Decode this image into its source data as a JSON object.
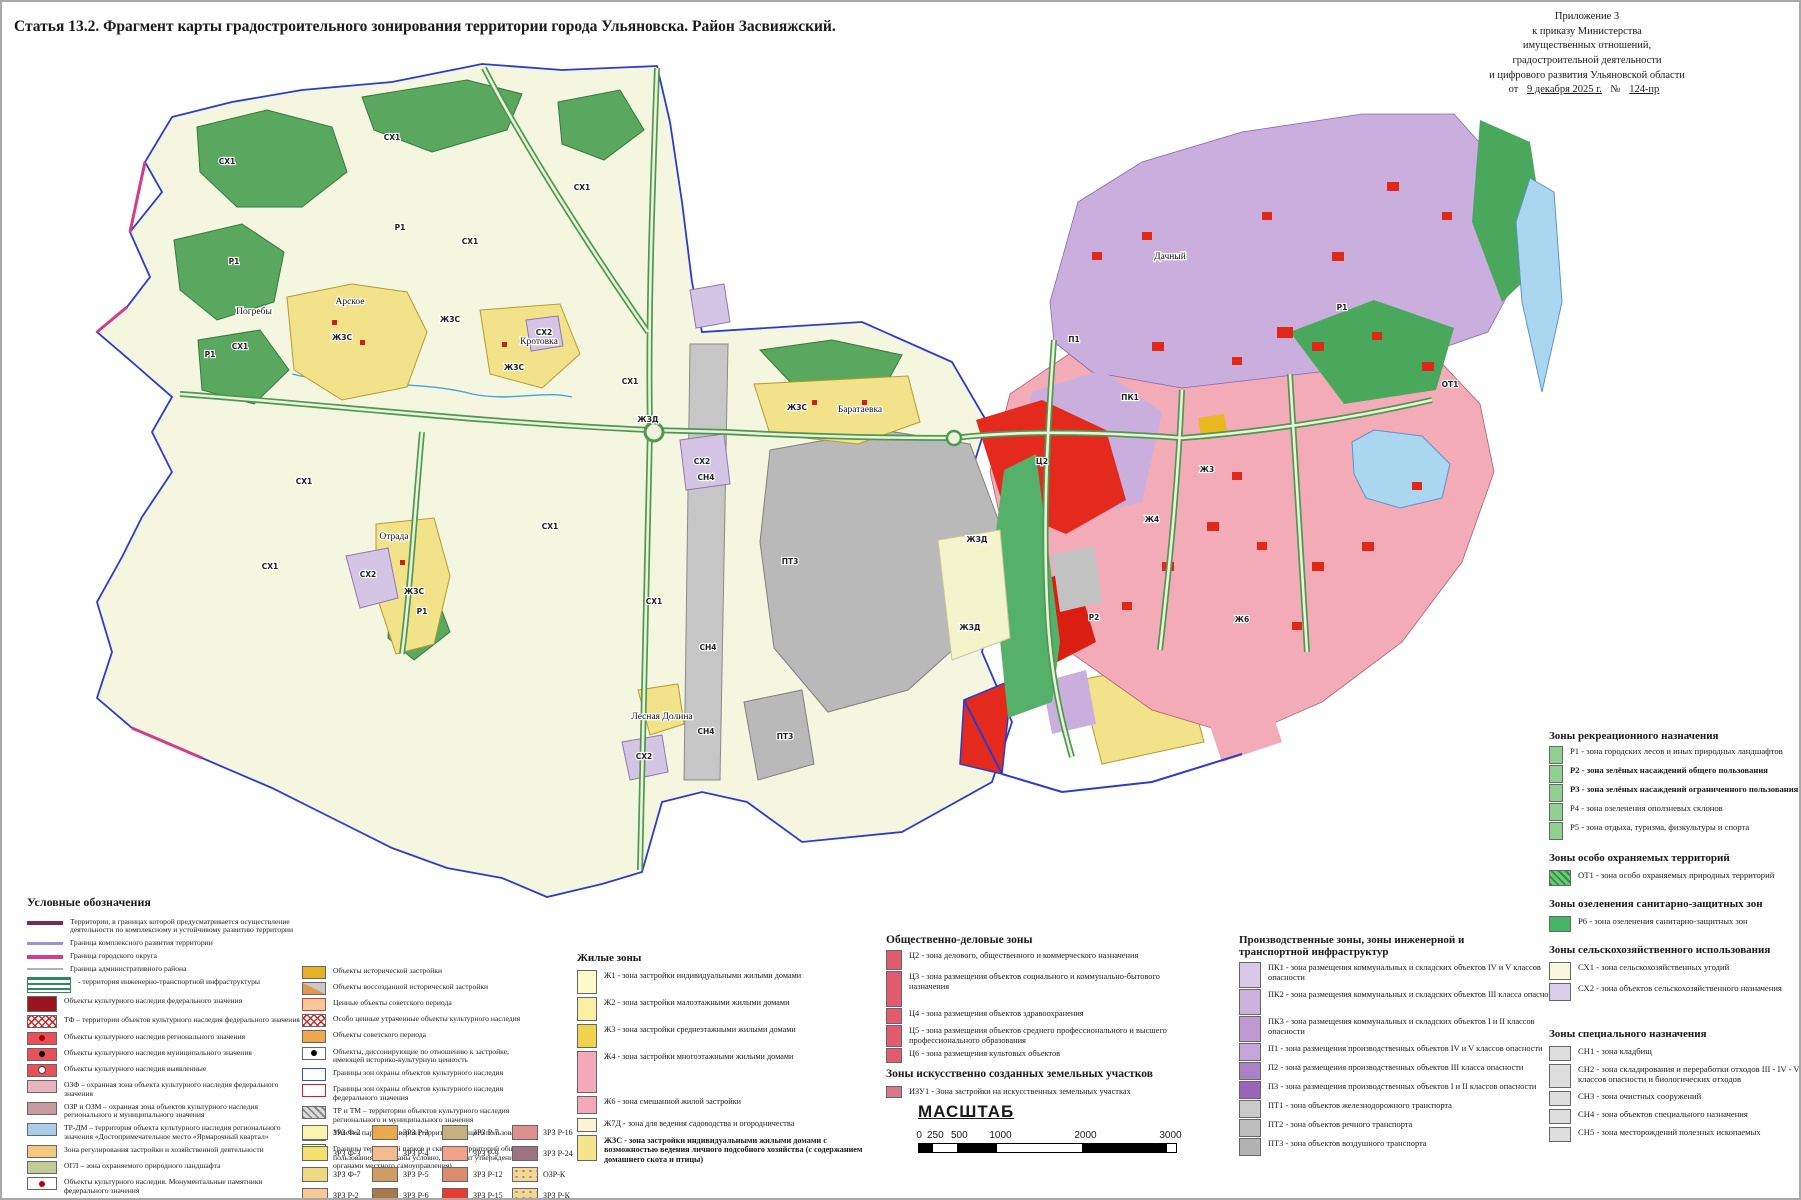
{
  "title": "Статья 13.2. Фрагмент карты градостроительного зонирования территории города Ульяновска. Район Засвияжский.",
  "annex": {
    "lines": [
      "Приложение 3",
      "к приказу Министерства",
      "имущественных отношений,",
      "градостроительной деятельности",
      "и цифрового развития Ульяновской области"
    ],
    "from": "от",
    "date": "9 декабря 2025 г.",
    "no": "№",
    "num": "124-пр"
  },
  "map": {
    "labels": [
      {
        "t": "СХ1",
        "x": 225,
        "y": 162
      },
      {
        "t": "СХ1",
        "x": 390,
        "y": 138
      },
      {
        "t": "СХ1",
        "x": 580,
        "y": 188
      },
      {
        "t": "СХ1",
        "x": 238,
        "y": 347
      },
      {
        "t": "СХ1",
        "x": 468,
        "y": 242
      },
      {
        "t": "СХ1",
        "x": 628,
        "y": 382
      },
      {
        "t": "СХ1",
        "x": 302,
        "y": 482
      },
      {
        "t": "СХ1",
        "x": 268,
        "y": 567
      },
      {
        "t": "СХ1",
        "x": 548,
        "y": 527
      },
      {
        "t": "СХ1",
        "x": 652,
        "y": 602
      },
      {
        "t": "Р1",
        "x": 398,
        "y": 228
      },
      {
        "t": "Р1",
        "x": 232,
        "y": 262
      },
      {
        "t": "Р1",
        "x": 208,
        "y": 355
      },
      {
        "t": "Р1",
        "x": 420,
        "y": 612
      },
      {
        "t": "ЖЗС",
        "x": 340,
        "y": 338
      },
      {
        "t": "ЖЗС",
        "x": 448,
        "y": 320
      },
      {
        "t": "ЖЗС",
        "x": 512,
        "y": 368
      },
      {
        "t": "ЖЗС",
        "x": 412,
        "y": 592
      },
      {
        "t": "ЖЗС",
        "x": 795,
        "y": 408
      },
      {
        "t": "СН4",
        "x": 704,
        "y": 478
      },
      {
        "t": "СН4",
        "x": 706,
        "y": 648
      },
      {
        "t": "СН4",
        "x": 704,
        "y": 732
      },
      {
        "t": "СХ2",
        "x": 366,
        "y": 575
      },
      {
        "t": "СХ2",
        "x": 700,
        "y": 462
      },
      {
        "t": "СХ2",
        "x": 542,
        "y": 333
      },
      {
        "t": "СХ2",
        "x": 642,
        "y": 757
      },
      {
        "t": "ПТ3",
        "x": 788,
        "y": 562
      },
      {
        "t": "ПТ3",
        "x": 783,
        "y": 737
      },
      {
        "t": "ЖЗД",
        "x": 646,
        "y": 420
      },
      {
        "t": "ЖЗД",
        "x": 975,
        "y": 540
      },
      {
        "t": "ЖЗД",
        "x": 968,
        "y": 628
      },
      {
        "t": "ПК1",
        "x": 1128,
        "y": 398
      },
      {
        "t": "П1",
        "x": 1072,
        "y": 340
      },
      {
        "t": "Ж4",
        "x": 1150,
        "y": 520
      },
      {
        "t": "Ж6",
        "x": 1240,
        "y": 620
      },
      {
        "t": "Ц2",
        "x": 1040,
        "y": 462
      },
      {
        "t": "Р1",
        "x": 1340,
        "y": 308
      },
      {
        "t": "ОТ1",
        "x": 1448,
        "y": 385
      },
      {
        "t": "Р2",
        "x": 1092,
        "y": 618
      },
      {
        "t": "Ж3",
        "x": 1205,
        "y": 470
      },
      {
        "t": "Погребы",
        "x": 252,
        "y": 312,
        "k": "place"
      },
      {
        "t": "Арское",
        "x": 348,
        "y": 302,
        "k": "place"
      },
      {
        "t": "Кротовка",
        "x": 537,
        "y": 342,
        "k": "place"
      },
      {
        "t": "Отрада",
        "x": 392,
        "y": 537,
        "k": "place"
      },
      {
        "t": "Баратаевка",
        "x": 858,
        "y": 410,
        "k": "place"
      },
      {
        "t": "Лесная Долина",
        "x": 660,
        "y": 717,
        "k": "place"
      },
      {
        "t": "Дачный",
        "x": 1168,
        "y": 257,
        "k": "place"
      }
    ]
  },
  "legend": {
    "conventions": {
      "heading": "Условные обозначения",
      "col1": [
        {
          "sw": {
            "line": 1,
            "bg": "#7b2a50",
            "h": 4
          },
          "label": "Территории, в границах которой предусматривается осуществление деятельности по комплексному и устойчивому развитию территории"
        },
        {
          "sw": {
            "line": 1,
            "bg": "#9d8fd6",
            "h": 3
          },
          "label": "Граница комплексного развития территории"
        },
        {
          "sw": {
            "line": 1,
            "bg": "#d23c8c",
            "h": 4
          },
          "label": "Граница городского округа"
        },
        {
          "sw": {
            "line": 1,
            "bg": "#b0b0b8",
            "h": 2
          },
          "label": "Граница административного района"
        },
        {
          "sw": {
            "cls": "hatchG",
            "w": 44,
            "h": 16
          },
          "label": "- территория инженерно-транспортной инфраструктуры"
        },
        {
          "sw": {
            "bg": "#9b1420",
            "h": 16
          },
          "label": "Объекты культурного наследия федерального значения"
        },
        {
          "sw": {
            "cls": "hatchRX"
          },
          "label": "ТФ – территории объектов культурного наследия федерального значения"
        },
        {
          "sw": {
            "bg": "#e8505a",
            "dot": "#b00000"
          },
          "label": "Объекты культурного наследия регионального значения"
        },
        {
          "sw": {
            "bg": "#e8505a",
            "dot": "#000000"
          },
          "label": "Объекты культурного наследия муниципального значения"
        },
        {
          "sw": {
            "bg": "#e8505a",
            "dot": "#fff"
          },
          "label": "Объекты культурного наследия  выявленные"
        },
        {
          "sw": {
            "bg": "#e8b4c0"
          },
          "label": "ОЗФ – охранная зона объекта культурного наследия федерального значения"
        },
        {
          "sw": {
            "bg": "#c79aa0"
          },
          "label": "ОЗР и ОЗМ – охранная зона объектов культурного наследия регионального и муниципального значения"
        },
        {
          "sw": {
            "bg": "#aacdec"
          },
          "label": "ТР-ДМ – территория объекта культурного наследия регионального значения «Достопримечательное место «Ярмарочный квартал»"
        },
        {
          "sw": {
            "bg": "#f5c980"
          },
          "label": "Зона регулирования застройки и хозяйственной деятельности"
        },
        {
          "sw": {
            "bg": "#c3cc96"
          },
          "label": "ОГЛ – зона охраняемого природного ландшафта"
        },
        {
          "sw": {
            "bg": "#ffffff",
            "dot": "#c00000"
          },
          "label": "Объекты культурного наследия. Монументальные памятники федерального значения"
        },
        {
          "sw": {
            "bg": "#ffffff",
            "spike": 1
          },
          "label": "Объекты культурного наследия. Мемориальные памятники регионального значения"
        },
        {
          "sw": {
            "bg": "#f5a623",
            "border": "#c87800"
          },
          "label": "Объекты, обладающие признаками объектов культурного наследия"
        },
        {
          "sw": {
            "bg": "#f0a830",
            "dot": "#c00000"
          },
          "label": "Объекты ценной исторической застройки"
        }
      ],
      "col2": [
        {
          "sw": {
            "bg": "#e8b028"
          },
          "label": "Объекты исторической застройки"
        },
        {
          "sw": {
            "cls": "split"
          },
          "label": "Объекты воссозданной исторической застройки"
        },
        {
          "sw": {
            "bg": "#f8c898",
            "border": "#d04040"
          },
          "label": "Ценные объекты советского периода"
        },
        {
          "sw": {
            "cls": "hatchRX"
          },
          "label": "Особо ценные утраченные объекты культурного наследия"
        },
        {
          "sw": {
            "bg": "#f0a850"
          },
          "label": "Объекты советского периода"
        },
        {
          "sw": {
            "bg": "#ffffff",
            "dot": "#000000"
          },
          "label": "Объекты, диссонирующие по отношению к застройке, имеющей историко-культурную ценность"
        },
        {
          "sw": {
            "bg": "#ffffff",
            "border": "#2255cc"
          },
          "label": "Границы зон охраны объектов культурного наследия"
        },
        {
          "sw": {
            "bg": "#ffffff",
            "border": "#cc2222"
          },
          "label": "Границы зон охраны объектов культурного наследия федерального значения"
        },
        {
          "sw": {
            "cls": "hatchGy"
          },
          "label": "ТР и ТМ – территории объектов культурного наследия регионального и муниципального значения"
        },
        {
          "sw": {
            "bg": "#d6e8a0"
          },
          "label": "Участки парков и скверов (территории общего пользования)"
        },
        {
          "sw": {
            "bg": "#ffffff",
            "border": "#3a7a1a"
          },
          "label": "Границы территорий парков и скверов (территорий общего пользования) (показаны условно, подлежат утверждению органами местного самоуправления)"
        }
      ],
      "zrz": [
        {
          "code": "ЗРЗ Ф-2",
          "sw": {
            "bg": "#faf3ae"
          }
        },
        {
          "code": "ЗРЗ Ф-3",
          "sw": {
            "bg": "#f4e070"
          }
        },
        {
          "code": "ЗРЗ Ф-7",
          "sw": {
            "bg": "#ecd982"
          }
        },
        {
          "code": "ЗРЗ Р-2",
          "sw": {
            "bg": "#f8c89a"
          }
        },
        {
          "code": "ЗРЗ Р-3",
          "sw": {
            "bg": "#eaa94e"
          }
        },
        {
          "code": "ЗРЗ Р-4",
          "sw": {
            "bg": "#f4ba8e"
          }
        },
        {
          "code": "ЗРЗ Р-5",
          "sw": {
            "bg": "#cf9d64"
          }
        },
        {
          "code": "ЗРЗ Р-6",
          "sw": {
            "bg": "#a9794b"
          }
        },
        {
          "code": "ЗРЗ Р-7",
          "sw": {
            "bg": "#c6b080"
          }
        },
        {
          "code": "ЗРЗ Р-9",
          "sw": {
            "bg": "#f2a288"
          }
        },
        {
          "code": "ЗРЗ Р-12",
          "sw": {
            "bg": "#db8e6e"
          }
        },
        {
          "code": "ЗРЗ Р-15",
          "sw": {
            "bg": "#e73c30"
          }
        },
        {
          "code": "ЗРЗ Р-16",
          "sw": {
            "bg": "#de9090"
          }
        },
        {
          "code": "ЗРЗ Р-24",
          "sw": {
            "bg": "#9e7280"
          }
        },
        {
          "code": "ОЗР-К",
          "sw": {
            "cls": "dots"
          }
        },
        {
          "code": "ЗРЗ Р-К",
          "sw": {
            "cls": "dots"
          }
        }
      ]
    },
    "residential": {
      "heading": "Жилые зоны",
      "items": [
        {
          "sw": {
            "bg": "#fdf9c8",
            "h": 24
          },
          "label": "Ж1  - зона застройки индивидуальными жилыми домами"
        },
        {
          "sw": {
            "bg": "#f8f0a2",
            "h": 24
          },
          "label": "Ж2  - зона застройки малоэтажными жилыми домами"
        },
        {
          "sw": {
            "bg": "#f1d44e",
            "h": 24
          },
          "label": "Ж3  - зона застройки среднеэтажными жилыми домами"
        },
        {
          "sw": {
            "bg": "#f3a9ba",
            "h": 42
          },
          "label": "Ж4  - зона застройки многоэтажными жилыми домами"
        },
        {
          "sw": {
            "bg": "#f3a9ba",
            "h": 18
          },
          "label": "Ж6 - зона смешанной жилой застройки"
        },
        {
          "sw": {
            "bg": "#fbf4d4",
            "h": 14
          },
          "label": "Ж7Д - зона для ведения садоводства и огородничества"
        },
        {
          "sw": {
            "bg": "#f3e48d",
            "h": 26
          },
          "bold": true,
          "label": "ЖЗС - зона застройки индивидуальными жилыми домами с возможностью ведения личного подсобного хозяйства (с содержанием домашнего скота и птицы)"
        }
      ]
    },
    "business": {
      "heading": "Общественно-деловые зоны",
      "items": [
        {
          "sw": {
            "bg": "#e25a6e",
            "h": 20
          },
          "label": "Ц2   - зона делового, общественного и коммерческого назначения"
        },
        {
          "sw": {
            "bg": "#e25a6e",
            "h": 36
          },
          "label": "Ц3   - зона размещения объектов социального и коммунально-бытового назначения"
        },
        {
          "sw": {
            "bg": "#e25a6e",
            "h": 16
          },
          "label": "Ц4 - зона размещения объектов здравоохранения"
        },
        {
          "sw": {
            "bg": "#e25a6e",
            "h": 22
          },
          "label": "Ц5 - зона размещения объектов среднего профессионального и высшего профессионального образования"
        },
        {
          "sw": {
            "bg": "#e25a6e",
            "h": 15
          },
          "label": "Ц6 - зона размещения культовых объектов"
        }
      ]
    },
    "izu": {
      "heading": "Зоны искусственно созданных земельных участков",
      "items": [
        {
          "sw": {
            "bg": "#d9788c",
            "h": 12
          },
          "label": "ИЗУ1 - Зона застройки на искусственных земельных участках"
        }
      ]
    },
    "scale": {
      "heading": "МАСШТАБ",
      "ticks": [
        {
          "t": "0",
          "x": 0
        },
        {
          "t": "250",
          "x": 14
        },
        {
          "t": "500",
          "x": 38
        },
        {
          "t": "1000",
          "x": 78
        },
        {
          "t": "2000",
          "x": 163
        },
        {
          "t": "3000",
          "x": 248
        }
      ]
    },
    "production": {
      "heading": "Производственные зоны, зоны инженерной и транспортной инфраструктур",
      "items": [
        {
          "sw": {
            "bg": "#d9c8e8",
            "h": 26
          },
          "label": "ПК1 - зона размещения коммунальных и складских объектов IV и V классов  опасности"
        },
        {
          "sw": {
            "bg": "#cdb2de",
            "h": 26
          },
          "label": "ПК2 - зона размещения коммунальных и складских объектов III класса  опасности"
        },
        {
          "sw": {
            "bg": "#bf9ad2",
            "h": 26
          },
          "label": "ПК3 - зона размещения коммунальных и складских объектов I и II классов  опасности"
        },
        {
          "sw": {
            "bg": "#c6a6da",
            "h": 18
          },
          "label": "П1 - зона размещения производственных объектов IV и V классов  опасности"
        },
        {
          "sw": {
            "bg": "#aa82c6",
            "h": 18
          },
          "label": "П2 - зона размещения производственных объектов III класса опасности"
        },
        {
          "sw": {
            "bg": "#9a64ba",
            "h": 18
          },
          "label": "П3 - зона размещения производственных объектов I и II классов  опасности"
        },
        {
          "sw": {
            "bg": "#cacaca",
            "h": 18
          },
          "label": "ПТ1 - зона объектов железнодорожного транспорта"
        },
        {
          "sw": {
            "bg": "#bdbdbd",
            "h": 18
          },
          "label": "ПТ2 - зона объектов речного транспорта"
        },
        {
          "sw": {
            "bg": "#b3b3b3",
            "h": 18
          },
          "label": "ПТ3 - зона объектов воздушного транспорта"
        }
      ]
    },
    "recreation": {
      "heading": "Зоны рекреационного назначения",
      "items": [
        {
          "sw": {
            "bg": "#90d090",
            "h": 18
          },
          "label": "Р1 - зона городских лесов и иных природных ландшафтов"
        },
        {
          "sw": {
            "bg": "#90d090",
            "h": 18
          },
          "bold": true,
          "label": "Р2 - зона зелёных насаждений общего пользования"
        },
        {
          "sw": {
            "bg": "#90d090",
            "h": 18
          },
          "bold": true,
          "label": "Р3 - зона зелёных насаждений ограниченного пользования"
        },
        {
          "sw": {
            "bg": "#90d090",
            "h": 18
          },
          "label": "Р4 - зона озеленения  оползневых склонов"
        },
        {
          "sw": {
            "bg": "#90d090",
            "h": 18
          },
          "label": "Р5 - зона отдыха, туризма, физкультуры и спорта"
        }
      ]
    },
    "protected_areas": {
      "heading": "Зоны особо охраняемых территорий",
      "items": [
        {
          "sw": {
            "cls": "hatchOT",
            "h": 16
          },
          "label": "ОТ1 - зона особо охраняемых природных территорий"
        }
      ]
    },
    "sanitary": {
      "heading": "Зоны озеленения санитарно-защитных зон",
      "items": [
        {
          "sw": {
            "bg": "#48b468",
            "h": 16
          },
          "label": "Р6 - зона озеленения санитарно-защитных зон"
        }
      ]
    },
    "agricultural": {
      "heading": "Зоны сельскохозяйственного использования",
      "items": [
        {
          "sw": {
            "bg": "#f8f8da",
            "h": 18
          },
          "label": "СХ1 - зона сельскохозяйственных угодий"
        },
        {
          "sw": {
            "bg": "#d9cdea",
            "h": 18
          },
          "label": "СХ2 - зона объектов сельскохозяйственного назначения"
        }
      ]
    },
    "special": {
      "heading": "Зоны специального назначения",
      "items": [
        {
          "sw": {
            "bg": "#dedede",
            "h": 15
          },
          "label": "СН1 - зона кладбищ"
        },
        {
          "sw": {
            "bg": "#dedede",
            "h": 24
          },
          "label": "СН2 - зона складирования и переработки отходов III - IV - V классов опасности  и биологических отходов"
        },
        {
          "sw": {
            "bg": "#dedede",
            "h": 15
          },
          "label": "СН3 - зона очистных сооружений"
        },
        {
          "sw": {
            "bg": "#dedede",
            "h": 15
          },
          "label": "СН4 - зона объектов специального назначения"
        },
        {
          "sw": {
            "bg": "#dedede",
            "h": 15
          },
          "label": "СН5 - зона месторождений полезных ископаемых"
        }
      ]
    }
  }
}
